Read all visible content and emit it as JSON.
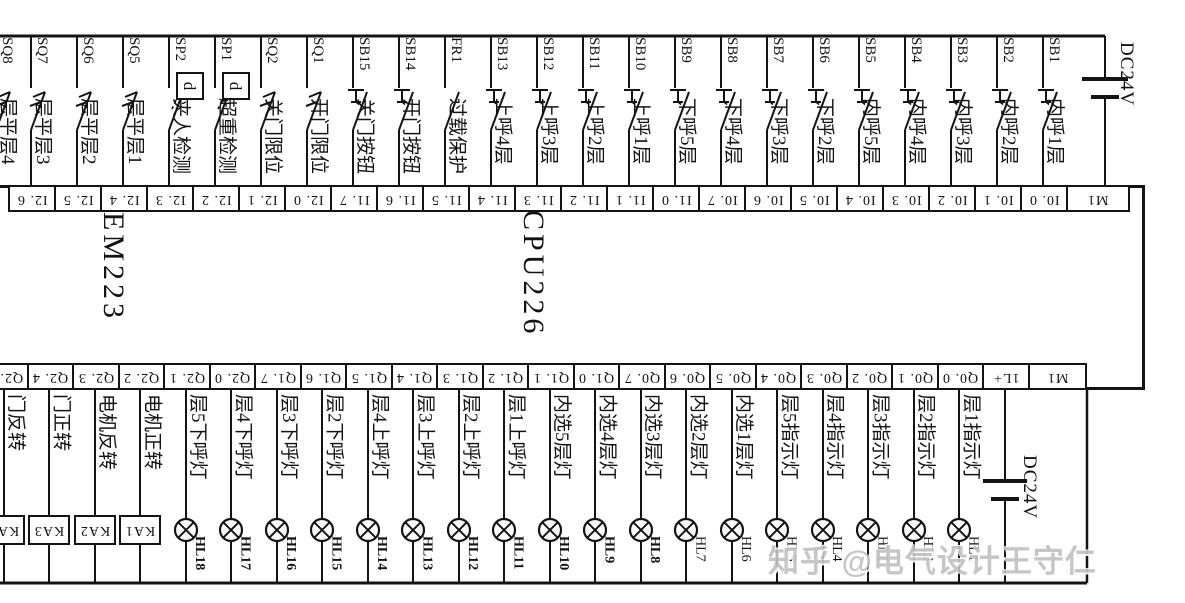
{
  "diagram": {
    "watermark": "知乎 @电气设计王守仁",
    "plc": {
      "left_module": "EM223",
      "right_module": "CPU226"
    },
    "power_top": {
      "label": "DC24V"
    },
    "power_bottom": {
      "label": "DC24V"
    },
    "line_color": "#141414",
    "watermark_color": "#c2c2c2",
    "top_terminals": [
      "I2. 6",
      "I2. 5",
      "I2. 4",
      "I2. 3",
      "I2. 2",
      "I2. 1",
      "I2. 0",
      "I1. 7",
      "I1. 6",
      "I1. 5",
      "I1. 4",
      "I1. 3",
      "I1. 2",
      "I1. 1",
      "I1. 0",
      "I0. 7",
      "I0. 6",
      "I0. 5",
      "I0. 4",
      "I0. 3",
      "I0. 2",
      "I0. 1",
      "I0. 0",
      "M1"
    ],
    "bottom_terminals": [
      "Q2. 5",
      "Q2. 4",
      "Q2. 3",
      "Q2. 2",
      "Q2. 1",
      "Q2. 0",
      "Q1. 7",
      "Q1. 6",
      "Q1. 5",
      "Q1. 4",
      "Q1. 3",
      "Q1. 2",
      "Q1. 1",
      "Q1. 0",
      "Q0. 7",
      "Q0. 6",
      "Q0. 5",
      "Q0. 4",
      "Q0. 3",
      "Q0. 2",
      "Q0. 1",
      "Q0. 0",
      "1L+",
      "M1"
    ],
    "top_devices": [
      {
        "id": "SQ8",
        "desc": "层平层4",
        "type": "limit",
        "terminal": ""
      },
      {
        "id": "SQ7",
        "desc": "层平层3",
        "type": "limit",
        "terminal": "I2.6"
      },
      {
        "id": "SQ6",
        "desc": "层平层2",
        "type": "limit",
        "terminal": "I2.5"
      },
      {
        "id": "SQ5",
        "desc": "层平层1",
        "type": "limit",
        "terminal": "I2.4"
      },
      {
        "id": "SP2",
        "desc": "夹人检测",
        "type": "sensor",
        "operator": "d",
        "terminal": "I2.3"
      },
      {
        "id": "SP1",
        "desc": "超重检测",
        "type": "sensor",
        "operator": "d",
        "terminal": "I2.2"
      },
      {
        "id": "SQ2",
        "desc": "关门限位",
        "type": "limit",
        "terminal": "I2.1"
      },
      {
        "id": "SQ1",
        "desc": "开门限位",
        "type": "limit",
        "terminal": "I2.0"
      },
      {
        "id": "SB15",
        "desc": "关门按钮",
        "type": "button",
        "terminal": "I1.7"
      },
      {
        "id": "SB14",
        "desc": "开门按钮",
        "type": "button",
        "terminal": "I1.6"
      },
      {
        "id": "FR1",
        "desc": "过载保护",
        "type": "contact",
        "terminal": "I1.5"
      },
      {
        "id": "SB13",
        "desc": "上呼4层",
        "type": "button",
        "terminal": "I1.4"
      },
      {
        "id": "SB12",
        "desc": "上呼3层",
        "type": "button",
        "terminal": "I1.3"
      },
      {
        "id": "SB11",
        "desc": "上呼2层",
        "type": "button",
        "terminal": "I1.2"
      },
      {
        "id": "SB10",
        "desc": "上呼1层",
        "type": "button",
        "terminal": "I1.1"
      },
      {
        "id": "SB9",
        "desc": "下呼5层",
        "type": "button",
        "terminal": "I1.0"
      },
      {
        "id": "SB8",
        "desc": "下呼4层",
        "type": "button",
        "terminal": "I0.7"
      },
      {
        "id": "SB7",
        "desc": "下呼3层",
        "type": "button",
        "terminal": "I0.6"
      },
      {
        "id": "SB6",
        "desc": "下呼2层",
        "type": "button",
        "terminal": "I0.5"
      },
      {
        "id": "SB5",
        "desc": "内呼5层",
        "type": "button",
        "terminal": "I0.4"
      },
      {
        "id": "SB4",
        "desc": "内呼4层",
        "type": "button",
        "terminal": "I0.3"
      },
      {
        "id": "SB3",
        "desc": "内呼3层",
        "type": "button",
        "terminal": "I0.2"
      },
      {
        "id": "SB2",
        "desc": "内呼2层",
        "type": "button",
        "terminal": "I0.1"
      },
      {
        "id": "SB1",
        "desc": "内呼1层",
        "type": "button",
        "terminal": "I0.0"
      }
    ],
    "bottom_devices": [
      {
        "id": "KA4",
        "desc": "门反转",
        "type": "relay",
        "terminal": "Q2.5"
      },
      {
        "id": "KA3",
        "desc": "门正转",
        "type": "relay",
        "terminal": "Q2.4"
      },
      {
        "id": "KA2",
        "desc": "电机反转",
        "type": "relay",
        "terminal": "Q2.3"
      },
      {
        "id": "KA1",
        "desc": "电机正转",
        "type": "relay",
        "terminal": "Q2.2"
      },
      {
        "id": "HL18",
        "desc": "层5下呼灯",
        "type": "lamp",
        "terminal": "Q2.1"
      },
      {
        "id": "HL17",
        "desc": "层4下呼灯",
        "type": "lamp",
        "terminal": "Q2.0"
      },
      {
        "id": "HL16",
        "desc": "层3下呼灯",
        "type": "lamp",
        "terminal": "Q1.7"
      },
      {
        "id": "HL15",
        "desc": "层2下呼灯",
        "type": "lamp",
        "terminal": "Q1.6"
      },
      {
        "id": "HL14",
        "desc": "层4上呼灯",
        "type": "lamp",
        "terminal": "Q1.5"
      },
      {
        "id": "HL13",
        "desc": "层3上呼灯",
        "type": "lamp",
        "terminal": "Q1.4"
      },
      {
        "id": "HL12",
        "desc": "层2上呼灯",
        "type": "lamp",
        "terminal": "Q1.3"
      },
      {
        "id": "HL11",
        "desc": "层1上呼灯",
        "type": "lamp",
        "terminal": "Q1.2"
      },
      {
        "id": "HL10",
        "desc": "内选5层灯",
        "type": "lamp",
        "terminal": "Q1.1"
      },
      {
        "id": "HL9",
        "desc": "内选4层灯",
        "type": "lamp",
        "terminal": "Q1.0"
      },
      {
        "id": "HL8",
        "desc": "内选3层灯",
        "type": "lamp",
        "terminal": "Q0.7"
      },
      {
        "id": "HL7",
        "desc": "内选2层灯",
        "type": "lamp",
        "terminal": "Q0.6"
      },
      {
        "id": "HL6",
        "desc": "内选1层灯",
        "type": "lamp",
        "terminal": "Q0.5"
      },
      {
        "id": "HL5",
        "desc": "层5指示灯",
        "type": "lamp",
        "terminal": "Q0.4"
      },
      {
        "id": "HL4",
        "desc": "层4指示灯",
        "type": "lamp",
        "terminal": "Q0.3"
      },
      {
        "id": "HL3",
        "desc": "层3指示灯",
        "type": "lamp",
        "terminal": "Q0.2"
      },
      {
        "id": "HL2",
        "desc": "层2指示灯",
        "type": "lamp",
        "terminal": "Q0.1"
      },
      {
        "id": "HL1",
        "desc": "层1指示灯",
        "type": "lamp",
        "terminal": "Q0.0"
      }
    ]
  }
}
